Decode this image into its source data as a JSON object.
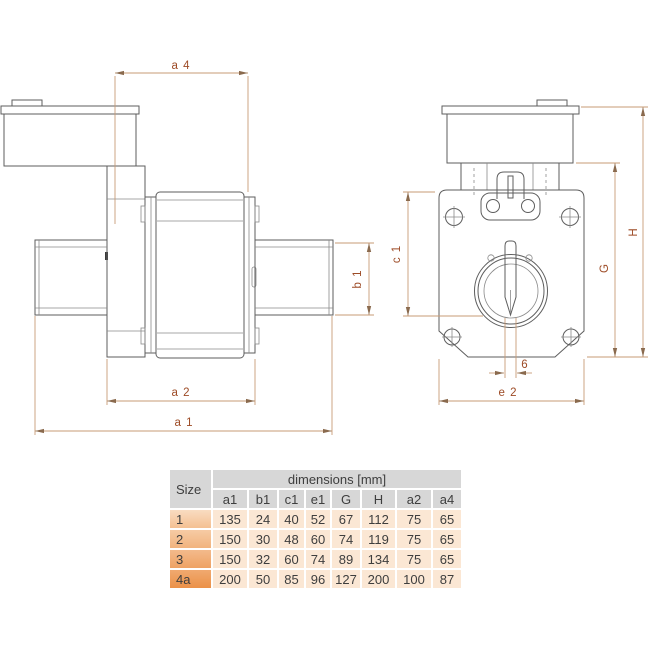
{
  "colors": {
    "outline": "#5e5e5e",
    "dimension_line": "#c79b76",
    "dimension_label": "#9d4b26",
    "table_header_bg": "#d7d7d7",
    "table_cell_bg": "#fbe7d4",
    "size_gradient_top": "#f9dcc1",
    "size_gradient_bottom": "#eb9148"
  },
  "drawing": {
    "left_view_labels": {
      "a4": "a 4",
      "b1": "b 1",
      "a2": "a 2",
      "a1": "a 1"
    },
    "right_view_labels": {
      "c1": "c 1",
      "G": "G",
      "H": "H",
      "slot_width": "6",
      "e2": "e 2"
    }
  },
  "table": {
    "size_header": "Size",
    "group_header": "dimensions [mm]",
    "columns": [
      "a1",
      "b1",
      "c1",
      "e1",
      "G",
      "H",
      "a2",
      "a4"
    ],
    "rows": [
      {
        "size": "1",
        "values": [
          135,
          24,
          40,
          52,
          67,
          112,
          75,
          65
        ]
      },
      {
        "size": "2",
        "values": [
          150,
          30,
          48,
          60,
          74,
          119,
          75,
          65
        ]
      },
      {
        "size": "3",
        "values": [
          150,
          32,
          60,
          74,
          89,
          134,
          75,
          65
        ]
      },
      {
        "size": "4a",
        "values": [
          200,
          50,
          85,
          96,
          127,
          200,
          100,
          87
        ]
      }
    ]
  }
}
